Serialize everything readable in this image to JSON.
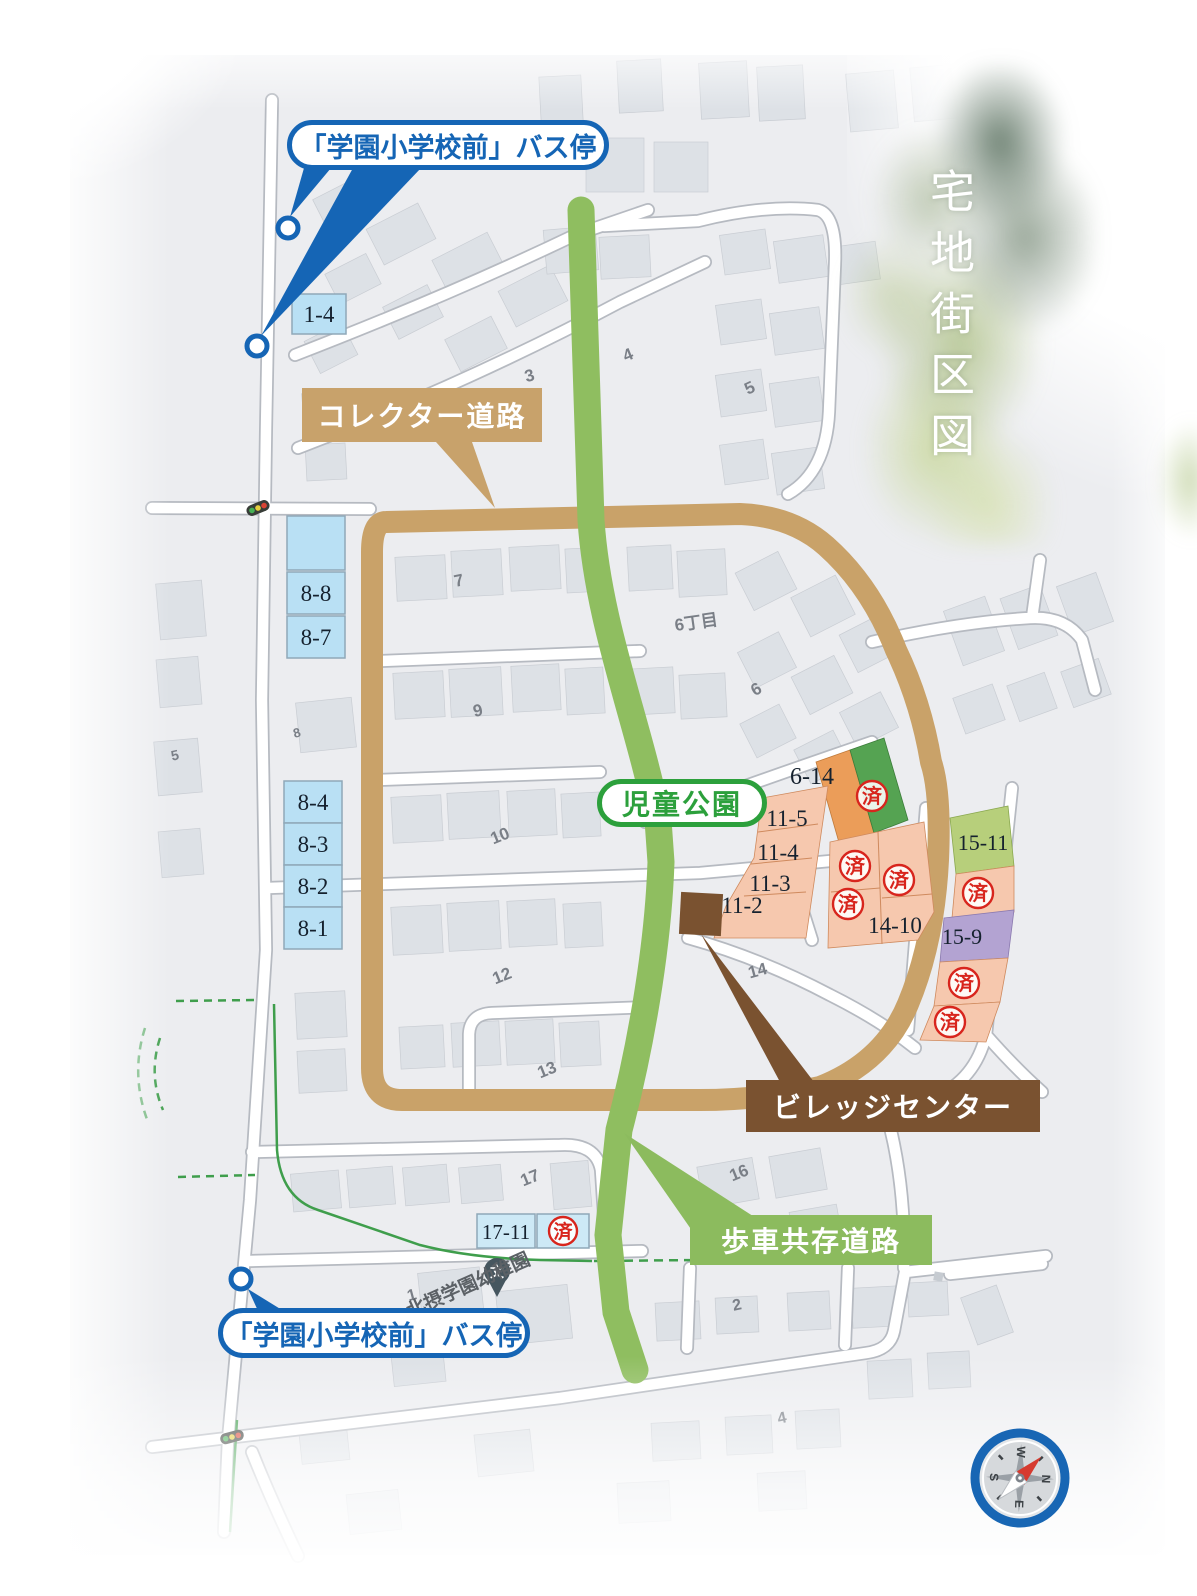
{
  "title": {
    "text": "宅地街区図"
  },
  "labels": {
    "bus_stop_top": "「学園小学校前」バス停",
    "bus_stop_bottom": "「学園小学校前」バス停",
    "collector_road": "コレクター道路",
    "children_park": "児童公園",
    "village_center": "ビレッジセンター",
    "shared_road": "歩車共存道路"
  },
  "stamp": {
    "sold": "済"
  },
  "lots": {
    "b1_4": "1-4",
    "b8_8": "8-8",
    "b8_7": "8-7",
    "b8_4": "8-4",
    "b8_3": "8-3",
    "b8_2": "8-2",
    "b8_1": "8-1",
    "b17_11": "17-11",
    "l6_14": "6-14",
    "l11_5": "11-5",
    "l11_4": "11-4",
    "l11_3": "11-3",
    "l11_2": "11-2",
    "l14_10": "14-10",
    "l15_11": "15-11",
    "l15_9": "15-9"
  },
  "map_numbers": {
    "n3": "3",
    "n4a": "4",
    "n5a": "5",
    "n7": "7",
    "n6c": "6丁目",
    "n6": "6",
    "n9": "9",
    "n8": "8",
    "n5b": "5",
    "n10": "10",
    "n12": "12",
    "n13": "13",
    "n14": "14",
    "n16": "16",
    "n17": "17",
    "n1": "1",
    "n2": "2",
    "n4b": "4"
  },
  "poi": {
    "kindergarten": "北摂学園幼稚園",
    "school_mark": "文"
  },
  "compass": {
    "n": "N",
    "e": "E",
    "s": "S",
    "w": "W"
  },
  "colors": {
    "collector_road": "#C8A26B",
    "shared_road": "#8CBB5E",
    "village_center": "#7A5230",
    "bus_blue": "#1565B5",
    "park_green": "#2CA03C",
    "road_tan": "#C9A269",
    "lot_salmon": "#F6C8AE",
    "lot_orange": "#EB9D59",
    "lot_green": "#55A352",
    "lot_lime": "#B7CF7B",
    "lot_purple": "#B3A3D2",
    "lot_blue": "#B9E0F4",
    "stamp_red": "#D8251D"
  }
}
